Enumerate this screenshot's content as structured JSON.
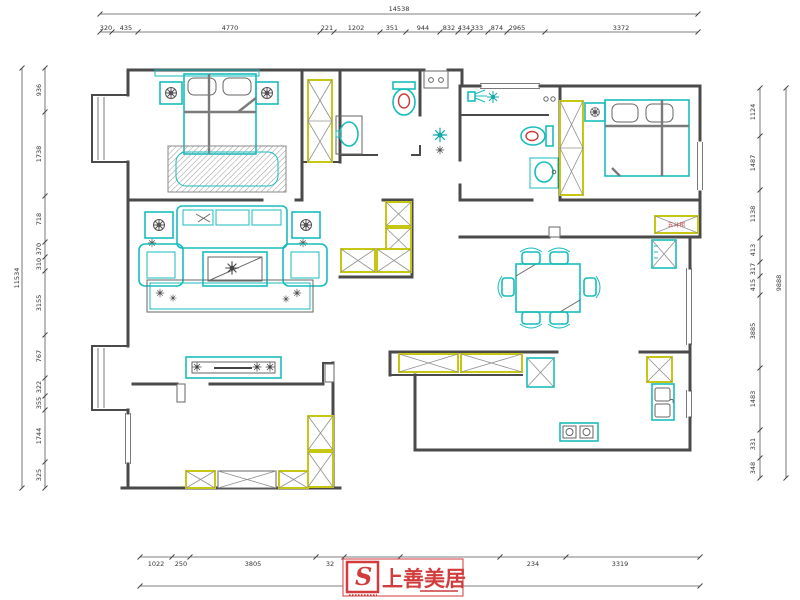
{
  "page": {
    "background": "#ffffff"
  },
  "logo": {
    "mark": "S",
    "brand": "上善美居"
  },
  "plan_labels": {
    "chest_cabinet": "五斗柜"
  },
  "colors": {
    "wall": "#4a4a4a",
    "furniture_cyan": "#18bcbc",
    "cabinet_yellow": "#c6c614",
    "accent_red": "#d23c3c",
    "dimension_text": "#333333"
  },
  "dim_chains": [
    {
      "name": "top-outer",
      "axis": "x",
      "text_pos": 11,
      "tick_pos": 14,
      "labels": [
        {
          "t": "14538",
          "p": 399
        }
      ],
      "ticks": [
        100,
        698
      ]
    },
    {
      "name": "top-inner",
      "axis": "x",
      "text_pos": 30,
      "tick_pos": 32,
      "labels": [
        {
          "t": "320",
          "p": 106
        },
        {
          "t": "435",
          "p": 126
        },
        {
          "t": "4770",
          "p": 230
        },
        {
          "t": "221",
          "p": 327
        },
        {
          "t": "1202",
          "p": 356
        },
        {
          "t": "351",
          "p": 392
        },
        {
          "t": "944",
          "p": 423
        },
        {
          "t": "832",
          "p": 449
        },
        {
          "t": "434",
          "p": 464
        },
        {
          "t": "333",
          "p": 477
        },
        {
          "t": "874",
          "p": 497
        },
        {
          "t": "2965",
          "p": 517
        },
        {
          "t": "3372",
          "p": 621
        }
      ],
      "ticks": [
        100,
        112,
        138,
        320,
        334,
        380,
        406,
        440,
        458,
        470,
        488,
        507,
        545,
        698
      ]
    },
    {
      "name": "bottom-inner",
      "axis": "x",
      "text_pos": 566,
      "tick_pos": 557,
      "labels": [
        {
          "t": "1022",
          "p": 156
        },
        {
          "t": "250",
          "p": 181
        },
        {
          "t": "3805",
          "p": 253
        },
        {
          "t": "32",
          "p": 330
        },
        {
          "t": "1131",
          "p": 372
        },
        {
          "t": "3337",
          "p": 451
        },
        {
          "t": "234",
          "p": 533
        },
        {
          "t": "3319",
          "p": 620
        }
      ],
      "ticks": [
        140,
        172,
        190,
        316,
        344,
        400,
        500,
        566,
        700
      ]
    },
    {
      "name": "bottom-outer",
      "axis": "x",
      "text_pos": 596,
      "tick_pos": 586,
      "labels": [
        {
          "t": "13135",
          "p": 396
        }
      ],
      "ticks": [
        140,
        700
      ]
    },
    {
      "name": "left-inner",
      "axis": "y",
      "text_pos": 41,
      "tick_pos": 45,
      "labels": [
        {
          "t": "936",
          "p": 90
        },
        {
          "t": "1738",
          "p": 154
        },
        {
          "t": "718",
          "p": 219
        },
        {
          "t": "370",
          "p": 249
        },
        {
          "t": "310",
          "p": 264
        },
        {
          "t": "3155",
          "p": 303
        },
        {
          "t": "767",
          "p": 356
        },
        {
          "t": "322",
          "p": 387
        },
        {
          "t": "355",
          "p": 403
        },
        {
          "t": "1744",
          "p": 436
        },
        {
          "t": "325",
          "p": 475
        }
      ],
      "ticks": [
        68,
        112,
        196,
        242,
        257,
        271,
        335,
        378,
        396,
        410,
        462,
        488
      ]
    },
    {
      "name": "left-outer",
      "axis": "y",
      "text_pos": 19,
      "tick_pos": 22,
      "labels": [
        {
          "t": "11534",
          "p": 278
        }
      ],
      "ticks": [
        68,
        488
      ]
    },
    {
      "name": "right-inner",
      "axis": "y",
      "text_pos": 755,
      "tick_pos": 760,
      "labels": [
        {
          "t": "1124",
          "p": 112
        },
        {
          "t": "1487",
          "p": 163
        },
        {
          "t": "1138",
          "p": 214
        },
        {
          "t": "413",
          "p": 250
        },
        {
          "t": "317",
          "p": 269
        },
        {
          "t": "415",
          "p": 285
        },
        {
          "t": "3885",
          "p": 331
        },
        {
          "t": "1483",
          "p": 399
        },
        {
          "t": "331",
          "p": 444
        },
        {
          "t": "348",
          "p": 468
        }
      ],
      "ticks": [
        88,
        136,
        190,
        238,
        262,
        276,
        295,
        368,
        430,
        458,
        478
      ]
    },
    {
      "name": "right-outer",
      "axis": "y",
      "text_pos": 781,
      "tick_pos": 786,
      "labels": [
        {
          "t": "9888",
          "p": 283
        }
      ],
      "ticks": [
        88,
        478
      ]
    }
  ]
}
